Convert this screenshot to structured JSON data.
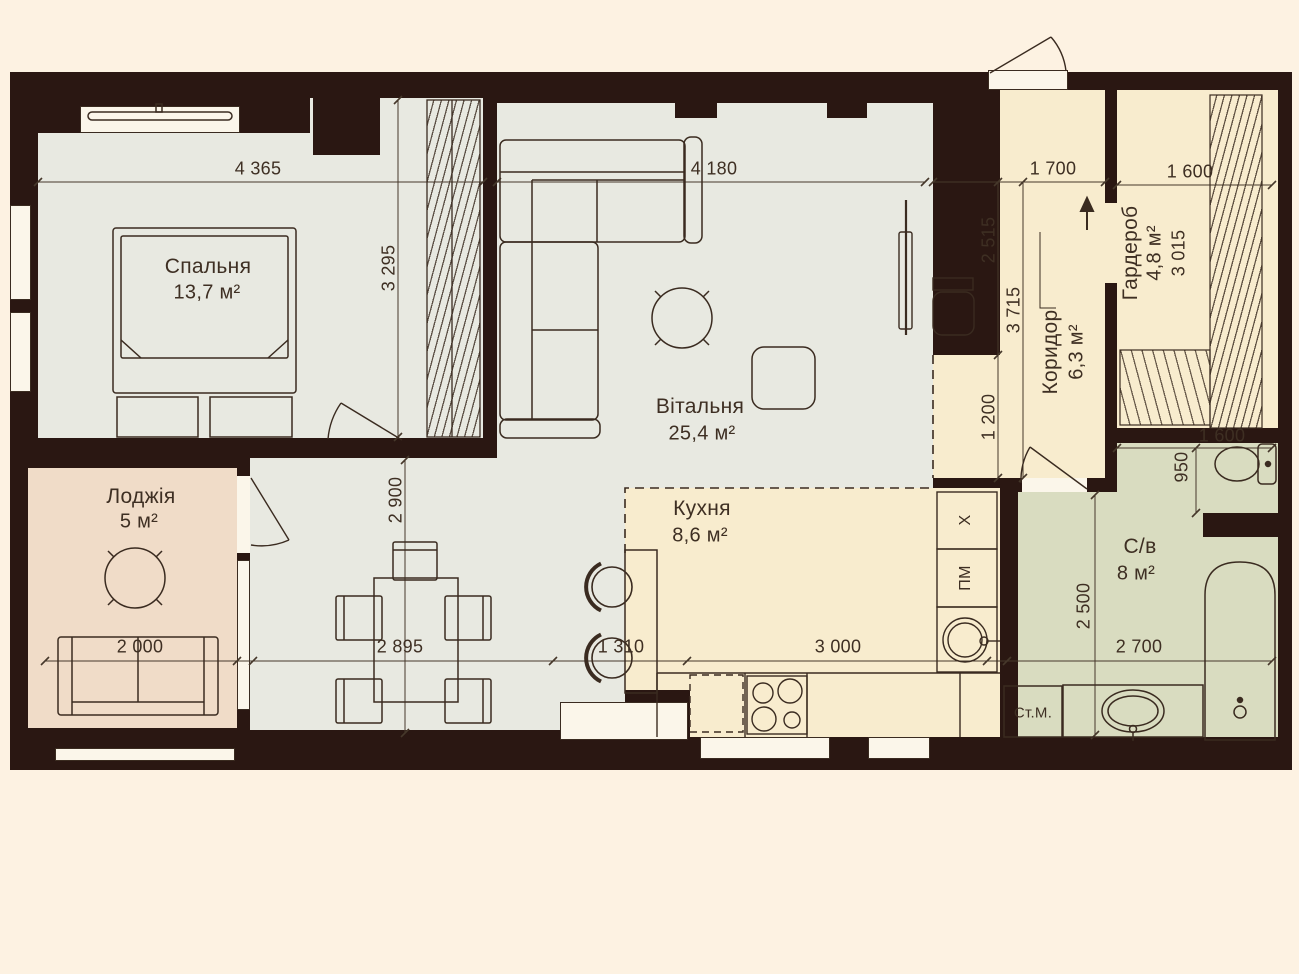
{
  "rooms": {
    "bedroom": {
      "name": "Спальня",
      "area": "13,7 м²"
    },
    "living": {
      "name": "Вітальня",
      "area": "25,4 м²"
    },
    "kitchen": {
      "name": "Кухня",
      "area": "8,6 м²"
    },
    "loggia": {
      "name": "Лоджія",
      "area": "5 м²"
    },
    "corridor": {
      "name": "Коридор",
      "area": "6,3 м²"
    },
    "wardrobe": {
      "name": "Гардероб",
      "area": "4,8 м²"
    },
    "bathroom": {
      "name": "С/в",
      "area": "8 м²"
    }
  },
  "appliances": {
    "washing_machine": "Ст.М.",
    "dishwasher": "ПМ",
    "fridge": "X"
  },
  "dims": {
    "bedroom_width": "4 365",
    "bedroom_depth": "3 295",
    "living_width": "4 180",
    "living_depth": "2 900",
    "corridor_width": "1 700",
    "corridor_upper": "2 515",
    "corridor_total": "3 715",
    "corridor_lower": "1 200",
    "wardrobe_width": "1 600",
    "wardrobe_depth": "3 015",
    "bath_top_width": "1 600",
    "wc_depth": "950",
    "bath_depth": "2 500",
    "bath_width": "2 700",
    "loggia_width": "2 000",
    "dining_width": "2 895",
    "bar_width": "1 310",
    "kitchen_width": "3 000"
  },
  "colors": {
    "paper": "#fdf2e2",
    "wall": "#2a1712",
    "floor_gray": "#e8e9e1",
    "floor_cream": "#f8ecce",
    "floor_green": "#d9dcc0",
    "floor_pink": "#f0dcc8",
    "linework": "#3a2b20"
  }
}
